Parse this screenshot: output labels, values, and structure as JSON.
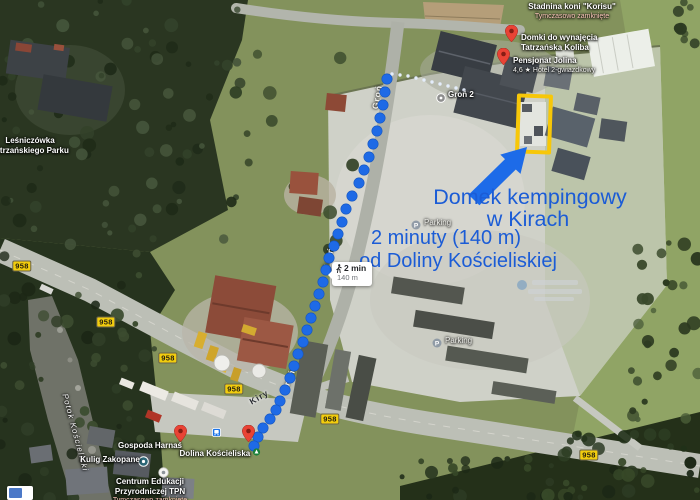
{
  "map": {
    "annotations": {
      "text_color": "#1b5cd6",
      "dest": {
        "line1": "Domek kempingowy",
        "line2": "w Kirach"
      },
      "dist": {
        "line1": "2 minuty (140 m)",
        "line2": "od Doliny Kościeliskiej"
      }
    },
    "tooltip": {
      "duration": "2 min",
      "distance": "140 m",
      "mode": "walking"
    },
    "shield": {
      "label": "958",
      "bg": "#f2cd0d",
      "positions": [
        [
          22,
          266
        ],
        [
          106,
          322
        ],
        [
          168,
          358
        ],
        [
          234,
          389
        ],
        [
          330,
          419
        ],
        [
          589,
          455
        ]
      ]
    },
    "route": {
      "dot_color": "#1e6ae6",
      "points": [
        [
          387,
          79
        ],
        [
          385,
          92
        ],
        [
          383,
          105
        ],
        [
          380,
          118
        ],
        [
          377,
          131
        ],
        [
          373,
          144
        ],
        [
          369,
          157
        ],
        [
          364,
          170
        ],
        [
          359,
          183
        ],
        [
          352,
          196
        ],
        [
          346,
          209
        ],
        [
          342,
          222
        ],
        [
          338,
          234
        ],
        [
          334,
          246
        ],
        [
          329,
          258
        ],
        [
          326,
          270
        ],
        [
          323,
          282
        ],
        [
          319,
          294
        ],
        [
          315,
          306
        ],
        [
          311,
          318
        ],
        [
          307,
          330
        ],
        [
          303,
          342
        ],
        [
          298,
          354
        ],
        [
          294,
          366
        ],
        [
          290,
          378
        ],
        [
          285,
          390
        ],
        [
          280,
          401
        ],
        [
          276,
          410
        ],
        [
          270,
          419
        ],
        [
          263,
          428
        ],
        [
          258,
          437
        ],
        [
          254,
          446
        ]
      ],
      "connector_color": "#e4edfb",
      "connector_points": [
        [
          392,
          74
        ],
        [
          400,
          75
        ],
        [
          408,
          76
        ],
        [
          416,
          78
        ],
        [
          424,
          80
        ],
        [
          432,
          82
        ],
        [
          440,
          84
        ],
        [
          448,
          86
        ],
        [
          456,
          88
        ],
        [
          464,
          90
        ]
      ]
    },
    "streets": [
      {
        "id": "gron-north",
        "t": "Groń",
        "x": 377,
        "y": 97,
        "r": -80,
        "v": "light"
      },
      {
        "id": "gron-mid",
        "t": "Groń",
        "x": 328,
        "y": 259,
        "r": -75,
        "v": "light"
      },
      {
        "id": "gron-south",
        "t": "Groń",
        "x": 288,
        "y": 381,
        "r": -68,
        "v": "light"
      },
      {
        "id": "kiry",
        "t": "Kiry",
        "x": 259,
        "y": 397,
        "r": -30,
        "v": "dark"
      }
    ],
    "pois": [
      {
        "id": "stadnina-koni",
        "lines": [
          "Stadnina koni \"Korisu\""
        ],
        "sub": "Tymczasowo zamknięte",
        "lx": 572,
        "ly": 2,
        "align": "center"
      },
      {
        "id": "domki-do-wynajecia",
        "lines": [
          "Domki do wynajęcia",
          "Tatrzańska Koliba"
        ],
        "pin": "red",
        "px": 511,
        "py": 42,
        "lx": 521,
        "ly": 33,
        "align": "left"
      },
      {
        "id": "pensjonat-jolina",
        "lines": [
          "Pensjonat Jolina"
        ],
        "sub": "4,6 ★ Hotel 2-gwiazdkowy",
        "subclass": "rate",
        "pin": "red",
        "px": 503,
        "py": 65,
        "lx": 513,
        "ly": 56,
        "align": "left"
      },
      {
        "id": "gron-2",
        "lines": [
          "Groń 2"
        ],
        "pin": "lodging",
        "px": 441,
        "py": 95,
        "lx": 448,
        "ly": 90,
        "align": "left"
      },
      {
        "id": "lesniczowka",
        "lines": [
          "Leśniczówka",
          "Tatrzańskiego Parku"
        ],
        "lx": 30,
        "ly": 136,
        "align": "center"
      },
      {
        "id": "potok-koscieliski",
        "lines": [
          "Potok Kościeliski"
        ],
        "lx": 75,
        "ly": 428,
        "align": "center",
        "rotate": 75,
        "italic": true
      },
      {
        "id": "kulig-zakopane",
        "lines": [
          "Kulig Zakopane"
        ],
        "pin": "teal",
        "px": 143,
        "py": 459,
        "lx": 110,
        "ly": 455,
        "align": "center"
      },
      {
        "id": "gospoda-harnas",
        "lines": [
          "Gospoda Harnaś"
        ],
        "pin": "red",
        "px": 180,
        "py": 442,
        "lx": 150,
        "ly": 441,
        "align": "center"
      },
      {
        "id": "dolina-koscieliska",
        "lines": [
          "Dolina Kościeliska"
        ],
        "pin": "red",
        "px": 248,
        "py": 442,
        "lx": 220,
        "ly": 448,
        "align": "center",
        "trail": "park"
      },
      {
        "id": "centrum-edukacji",
        "lines": [
          "Centrum Edukacji",
          "Przyrodniczej TPN"
        ],
        "sub": "Tymczasowo zamknięte",
        "pin": "white",
        "px": 163,
        "py": 470,
        "lx": 150,
        "ly": 477,
        "align": "center"
      },
      {
        "id": "parking-north",
        "lines": [
          "Parking"
        ],
        "pin": "parking",
        "px": 416,
        "py": 222,
        "lx": 424,
        "ly": 218,
        "align": "left",
        "faint": true
      },
      {
        "id": "parking-south",
        "lines": [
          "Parking"
        ],
        "pin": "parking",
        "px": 437,
        "py": 340,
        "lx": 445,
        "ly": 336,
        "align": "left",
        "faint": true
      },
      {
        "id": "bus-stop",
        "lines": [],
        "pin": "transit",
        "px": 217,
        "py": 429
      }
    ]
  }
}
